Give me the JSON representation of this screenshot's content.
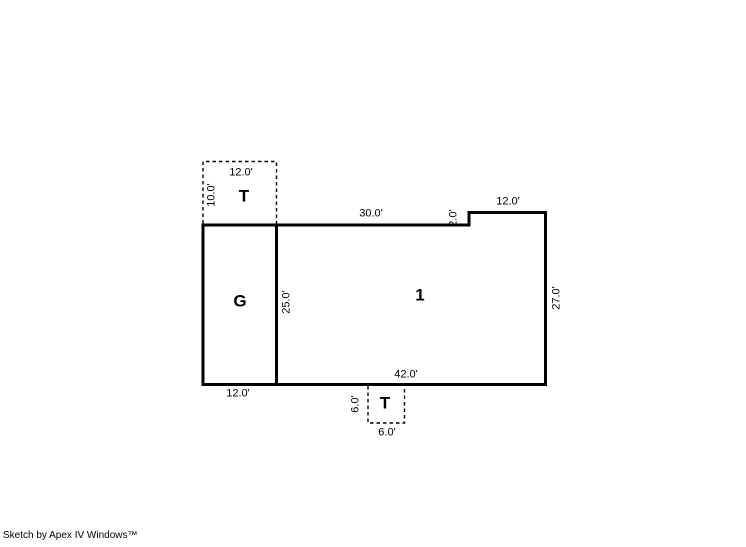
{
  "page": {
    "background_color": "#ffffff",
    "line_color": "#000000"
  },
  "plan": {
    "areas": {
      "main": "1",
      "garage": "G",
      "top_porch": "T",
      "bottom_porch": "T"
    },
    "dimensions": {
      "top_porch_width": "12.0'",
      "top_porch_depth": "10.0'",
      "main_top": "30.0'",
      "jog": "2.0'",
      "main_top_right": "12.0'",
      "main_right": "27.0'",
      "garage_depth": "25.0'",
      "main_bottom": "42.0'",
      "garage_width": "12.0'",
      "bottom_porch_depth": "6.0'",
      "bottom_porch_width": "6.0'"
    }
  },
  "footer": {
    "credit": "Sketch by Apex IV Windows™"
  }
}
